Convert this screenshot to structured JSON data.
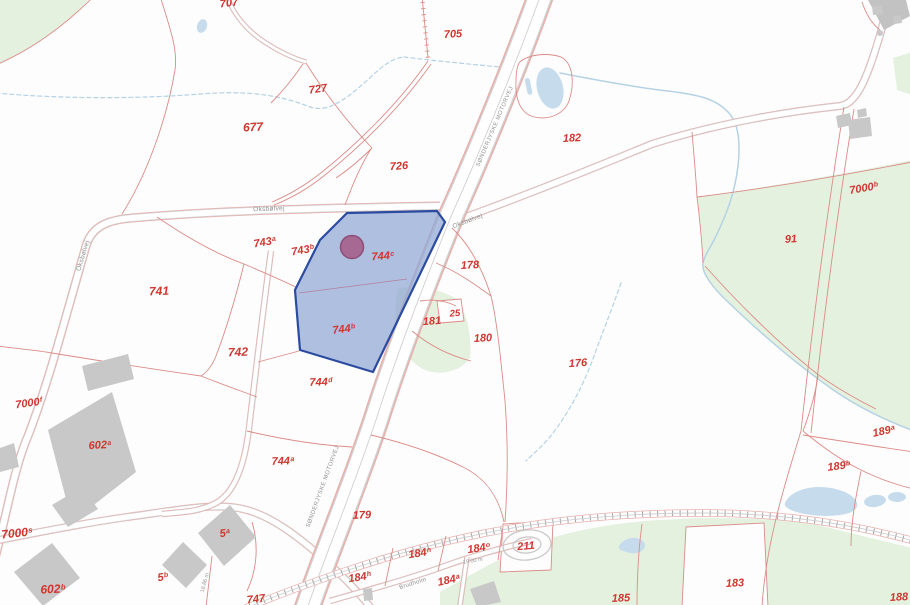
{
  "colors": {
    "background": "#fdfdfd",
    "label_red": "#cf3630",
    "line_red": "#dc8b87",
    "road_pink": "#e7b0ac",
    "road_gray": "#d2d2d2",
    "road_fill": "#ffffff",
    "green": "#e4f1df",
    "water_fill": "#c6dcec",
    "water_line": "#b5d2e4",
    "building_gray": "#c8c8c8",
    "road_label_gray": "#8f8f8f",
    "highlight_fill": "#8fa6d4",
    "highlight_stroke": "#2b4ba0",
    "marker_fill": "#a4628c",
    "marker_stroke": "#8e4e78"
  },
  "parcel_labels": [
    {
      "base": "707",
      "x": 229,
      "y": 4,
      "rot": -6
    },
    {
      "base": "705",
      "x": 453,
      "y": 35,
      "rot": -3
    },
    {
      "base": "727",
      "x": 318,
      "y": 90,
      "rot": -8
    },
    {
      "base": "677",
      "x": 253,
      "y": 127,
      "size": 12,
      "rot": -3
    },
    {
      "base": "726",
      "x": 399,
      "y": 167,
      "rot": -4
    },
    {
      "base": "182",
      "x": 572,
      "y": 139,
      "rot": -3
    },
    {
      "base": "7000",
      "sup": "b",
      "x": 864,
      "y": 189,
      "rot": -10
    },
    {
      "base": "91",
      "x": 791,
      "y": 240,
      "rot": -4
    },
    {
      "base": "743",
      "sup": "a",
      "x": 265,
      "y": 243,
      "rot": -10
    },
    {
      "base": "743",
      "sup": "b",
      "x": 303,
      "y": 251,
      "rot": -10
    },
    {
      "base": "744",
      "sup": "c",
      "x": 383,
      "y": 257,
      "rot": -4
    },
    {
      "base": "178",
      "x": 470,
      "y": 266,
      "rot": -3
    },
    {
      "base": "741",
      "x": 159,
      "y": 291,
      "size": 12,
      "rot": -2
    },
    {
      "base": "181",
      "x": 432,
      "y": 322,
      "rot": -4
    },
    {
      "base": "25",
      "x": 455,
      "y": 314,
      "size": 9.5,
      "rot": -4
    },
    {
      "base": "744",
      "sup": "b",
      "x": 344,
      "y": 330,
      "rot": -7
    },
    {
      "base": "180",
      "x": 483,
      "y": 339,
      "rot": -3
    },
    {
      "base": "742",
      "x": 238,
      "y": 352,
      "size": 12,
      "rot": -2
    },
    {
      "base": "176",
      "x": 578,
      "y": 364,
      "rot": -4
    },
    {
      "base": "744",
      "sup": "d",
      "x": 321,
      "y": 383,
      "rot": -2
    },
    {
      "base": "7000",
      "sup": "f",
      "x": 29,
      "y": 404,
      "rot": -8
    },
    {
      "base": "189",
      "sup": "a",
      "x": 884,
      "y": 432,
      "rot": -12
    },
    {
      "base": "602",
      "sup": "a",
      "x": 100,
      "y": 446,
      "rot": -3
    },
    {
      "base": "744",
      "sup": "a",
      "x": 283,
      "y": 462,
      "rot": -2
    },
    {
      "base": "189",
      "sup": "b",
      "x": 839,
      "y": 467,
      "rot": -7
    },
    {
      "base": "179",
      "x": 362,
      "y": 516,
      "rot": -2
    },
    {
      "base": "7000",
      "sup": "s",
      "x": 17,
      "y": 533,
      "size": 12,
      "rot": -6
    },
    {
      "base": "5",
      "sup": "a",
      "x": 225,
      "y": 534,
      "rot": -8
    },
    {
      "base": "211",
      "x": 526,
      "y": 547,
      "rot": -5
    },
    {
      "base": "184",
      "sup": "n",
      "x": 420,
      "y": 554,
      "rot": -9
    },
    {
      "base": "184",
      "sup": "o",
      "x": 479,
      "y": 549,
      "rot": -9
    },
    {
      "base": "5",
      "sup": "b",
      "x": 163,
      "y": 578,
      "rot": -8
    },
    {
      "base": "184",
      "sup": "h",
      "x": 360,
      "y": 578,
      "rot": -9
    },
    {
      "base": "184",
      "sup": "a",
      "x": 449,
      "y": 581,
      "rot": -12
    },
    {
      "base": "183",
      "x": 735,
      "y": 584,
      "rot": -3
    },
    {
      "base": "602",
      "sup": "b",
      "x": 53,
      "y": 589,
      "size": 12,
      "rot": -3
    },
    {
      "base": "188",
      "x": 899,
      "y": 598,
      "rot": -3
    },
    {
      "base": "185",
      "x": 621,
      "y": 599,
      "rot": -2
    },
    {
      "base": "747",
      "x": 256,
      "y": 600,
      "rot": -6
    }
  ],
  "road_labels": [
    {
      "text": "Oksbølvej",
      "x": 269,
      "y": 210,
      "rot": -2,
      "size": 6.5,
      "spacing": 0.3
    },
    {
      "text": "Oksbølvej",
      "x": 84,
      "y": 256,
      "rot": -73,
      "size": 6.5,
      "spacing": 0.3
    },
    {
      "text": "Oksbølvej",
      "x": 468,
      "y": 222,
      "rot": -21,
      "size": 6.5,
      "spacing": 0.3
    },
    {
      "text": "SØNDERJYSKE MOTORVEJ",
      "x": 496,
      "y": 127,
      "rot": -67,
      "size": 5.8,
      "spacing": 0.5
    },
    {
      "text": "SØNDERJYSKE MOTORVEJ",
      "x": 324,
      "y": 487,
      "rot": -70,
      "size": 5.8,
      "spacing": 0.5
    },
    {
      "text": "Brudholm",
      "x": 413,
      "y": 584,
      "rot": -17,
      "size": 6,
      "spacing": 0.3
    }
  ],
  "dimension_labels": [
    {
      "text": "18.86 m",
      "x": 206,
      "y": 583,
      "rot": -75,
      "size": 5.5
    },
    {
      "text": "19.00 m",
      "x": 473,
      "y": 562,
      "rot": -9,
      "size": 5.5
    }
  ]
}
